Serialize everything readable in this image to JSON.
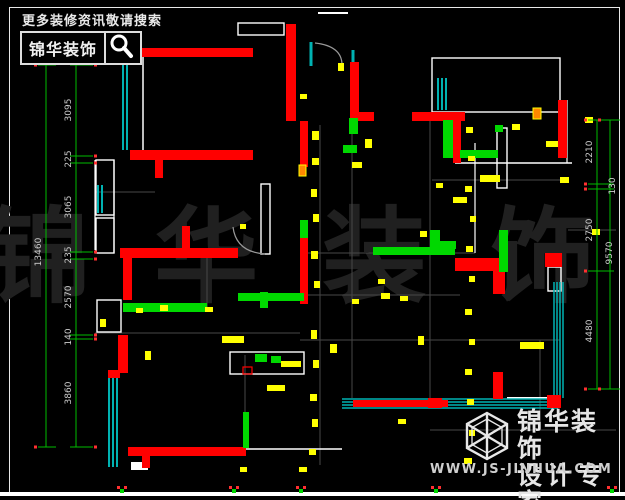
{
  "header": {
    "hint": "更多装修资讯敬请搜索",
    "brand": "锦华装饰",
    "search_icon": "magnifier-icon"
  },
  "watermark": {
    "text": "锦 华 装 饰"
  },
  "logo": {
    "line1": "锦华装饰",
    "line2": "设计专家",
    "url": "WWW.JS-JINHUA.COM",
    "icon": "cube-hexagon-icon"
  },
  "dims": {
    "left": {
      "outer_x": 46,
      "inner_x": 76,
      "y_top": 65,
      "y_bottom": 447,
      "ticks": [
        65,
        156,
        163,
        252,
        259,
        335,
        339,
        447
      ],
      "labels": [
        {
          "t": "3095",
          "y": 110
        },
        {
          "t": "225",
          "y": 159
        },
        {
          "t": "3065",
          "y": 207
        },
        {
          "t": "235",
          "y": 255
        },
        {
          "t": "2570",
          "y": 297
        },
        {
          "t": "140",
          "y": 337
        },
        {
          "t": "3860",
          "y": 393
        }
      ],
      "total": {
        "t": "13460",
        "x": 41,
        "y": 252
      }
    },
    "right": {
      "outer_x": 610,
      "inner_x": 597,
      "y_top": 120,
      "y_bottom": 389,
      "ticks": [
        120,
        184,
        189,
        271,
        389
      ],
      "labels": [
        {
          "t": "2210",
          "x": 592,
          "y": 152
        },
        {
          "t": "130",
          "x": 615,
          "y": 186
        },
        {
          "t": "2750",
          "x": 592,
          "y": 230
        },
        {
          "t": "4480",
          "x": 592,
          "y": 331
        }
      ],
      "total": {
        "t": "9570",
        "x": 612,
        "y": 253
      }
    }
  },
  "plan": {
    "colors": {
      "wall": "#ff0000",
      "window": "#00b2b2",
      "pipe": "#00d800",
      "mark": "#ffff00",
      "dim": "#00bb00",
      "line": "#ffffff",
      "faint": "#474747",
      "dot": "#ff3030",
      "orange": "#ff8800",
      "dim_text": "#cccccc",
      "arc": "#999999"
    },
    "red_walls": [
      [
        135,
        48,
        118,
        9
      ],
      [
        286,
        24,
        10,
        97
      ],
      [
        300,
        121,
        8,
        46
      ],
      [
        300,
        236,
        8,
        68
      ],
      [
        350,
        62,
        9,
        59
      ],
      [
        350,
        112,
        24,
        9
      ],
      [
        412,
        112,
        53,
        9
      ],
      [
        453,
        121,
        8,
        42
      ],
      [
        558,
        100,
        9,
        58
      ],
      [
        130,
        150,
        123,
        10
      ],
      [
        155,
        160,
        8,
        18
      ],
      [
        120,
        248,
        118,
        10
      ],
      [
        182,
        226,
        8,
        22
      ],
      [
        123,
        258,
        9,
        42
      ],
      [
        118,
        335,
        10,
        38
      ],
      [
        108,
        370,
        12,
        8
      ],
      [
        128,
        447,
        118,
        9
      ],
      [
        142,
        456,
        8,
        12
      ],
      [
        455,
        258,
        47,
        13
      ],
      [
        493,
        271,
        12,
        23
      ],
      [
        545,
        253,
        17,
        14
      ],
      [
        493,
        372,
        10,
        27
      ],
      [
        547,
        395,
        14,
        13
      ],
      [
        353,
        400,
        95,
        7
      ],
      [
        428,
        398,
        14,
        10
      ]
    ],
    "red_outlines": [
      [
        243,
        367,
        9,
        7
      ]
    ],
    "orange_marks": [
      [
        299,
        165,
        7,
        11
      ],
      [
        533,
        108,
        8,
        11
      ]
    ],
    "green_bars": [
      [
        123,
        303,
        84,
        9
      ],
      [
        238,
        293,
        66,
        8
      ],
      [
        260,
        292,
        8,
        16
      ],
      [
        373,
        247,
        82,
        8
      ],
      [
        499,
        230,
        9,
        42
      ],
      [
        443,
        120,
        10,
        38
      ],
      [
        460,
        150,
        38,
        8
      ],
      [
        430,
        230,
        10,
        18
      ],
      [
        430,
        241,
        26,
        8
      ],
      [
        243,
        412,
        6,
        36
      ],
      [
        300,
        220,
        8,
        18
      ],
      [
        255,
        354,
        12,
        8
      ],
      [
        271,
        356,
        10,
        7
      ],
      [
        343,
        145,
        14,
        8
      ],
      [
        349,
        118,
        9,
        16
      ],
      [
        495,
        125,
        8,
        7
      ]
    ],
    "yellow_marks": [
      [
        312,
        131,
        7,
        9
      ],
      [
        312,
        158,
        7,
        7
      ],
      [
        311,
        189,
        6,
        8
      ],
      [
        313,
        214,
        6,
        8
      ],
      [
        311,
        251,
        7,
        8
      ],
      [
        314,
        281,
        6,
        7
      ],
      [
        311,
        330,
        6,
        9
      ],
      [
        313,
        360,
        6,
        8
      ],
      [
        310,
        394,
        7,
        7
      ],
      [
        312,
        419,
        6,
        8
      ],
      [
        309,
        449,
        7,
        6
      ],
      [
        466,
        127,
        7,
        6
      ],
      [
        468,
        156,
        7,
        5
      ],
      [
        465,
        186,
        7,
        6
      ],
      [
        470,
        216,
        6,
        6
      ],
      [
        466,
        246,
        7,
        6
      ],
      [
        469,
        276,
        6,
        6
      ],
      [
        465,
        309,
        7,
        6
      ],
      [
        469,
        339,
        6,
        6
      ],
      [
        465,
        369,
        7,
        6
      ],
      [
        467,
        399,
        7,
        6
      ],
      [
        469,
        430,
        6,
        6
      ],
      [
        464,
        458,
        8,
        6
      ],
      [
        381,
        293,
        9,
        6
      ],
      [
        400,
        296,
        8,
        5
      ],
      [
        352,
        299,
        7,
        5
      ],
      [
        160,
        305,
        8,
        6
      ],
      [
        136,
        308,
        7,
        5
      ],
      [
        205,
        307,
        8,
        5
      ],
      [
        222,
        336,
        22,
        7
      ],
      [
        281,
        361,
        20,
        6
      ],
      [
        330,
        344,
        7,
        9
      ],
      [
        418,
        336,
        6,
        9
      ],
      [
        267,
        385,
        18,
        6
      ],
      [
        520,
        342,
        24,
        7
      ],
      [
        480,
        175,
        20,
        7
      ],
      [
        453,
        197,
        14,
        6
      ],
      [
        352,
        162,
        10,
        6
      ],
      [
        365,
        139,
        7,
        9
      ],
      [
        546,
        141,
        12,
        6
      ],
      [
        560,
        177,
        9,
        6
      ],
      [
        585,
        117,
        8,
        6
      ],
      [
        592,
        229,
        8,
        6
      ],
      [
        436,
        183,
        7,
        5
      ],
      [
        512,
        124,
        8,
        6
      ],
      [
        300,
        94,
        7,
        5
      ],
      [
        145,
        351,
        6,
        9
      ],
      [
        100,
        319,
        6,
        8
      ],
      [
        240,
        224,
        6,
        5
      ],
      [
        398,
        419,
        8,
        5
      ],
      [
        299,
        467,
        8,
        5
      ],
      [
        240,
        467,
        7,
        5
      ],
      [
        338,
        63,
        6,
        8
      ],
      [
        420,
        231,
        7,
        6
      ],
      [
        378,
        279,
        7,
        5
      ]
    ],
    "teal_lines": [
      [
        123,
        62,
        123,
        150,
        2
      ],
      [
        127,
        62,
        127,
        150,
        2
      ],
      [
        98,
        185,
        98,
        213,
        2
      ],
      [
        102,
        185,
        102,
        213,
        2
      ],
      [
        109,
        377,
        109,
        467,
        2
      ],
      [
        113,
        377,
        113,
        467,
        2
      ],
      [
        117,
        377,
        117,
        467,
        2
      ],
      [
        342,
        399,
        558,
        399,
        1.5
      ],
      [
        342,
        402,
        558,
        402,
        1.5
      ],
      [
        342,
        405,
        558,
        405,
        1.5
      ],
      [
        342,
        408,
        558,
        408,
        1.5
      ],
      [
        554,
        282,
        554,
        398,
        1.5
      ],
      [
        557,
        282,
        557,
        398,
        1.5
      ],
      [
        560,
        282,
        560,
        398,
        1.5
      ],
      [
        563,
        282,
        563,
        398,
        1.5
      ],
      [
        438,
        78,
        438,
        110,
        2
      ],
      [
        442,
        78,
        442,
        110,
        2
      ],
      [
        446,
        78,
        446,
        110,
        2
      ],
      [
        311,
        42,
        311,
        66,
        3
      ],
      [
        353,
        50,
        353,
        66,
        3
      ]
    ],
    "white_rect_outlines": [
      [
        238,
        23,
        46,
        12
      ],
      [
        432,
        58,
        128,
        54
      ],
      [
        96,
        160,
        18,
        55
      ],
      [
        96,
        218,
        18,
        35
      ],
      [
        261,
        184,
        9,
        70
      ],
      [
        497,
        128,
        10,
        60
      ],
      [
        97,
        300,
        24,
        32
      ],
      [
        230,
        352,
        74,
        22
      ],
      [
        548,
        267,
        13,
        24
      ]
    ],
    "white_rect_fills": [
      [
        131,
        462,
        17,
        8
      ]
    ],
    "white_lines": [
      [
        318,
        13,
        348,
        13,
        2
      ],
      [
        143,
        57,
        143,
        152,
        1.5
      ],
      [
        114,
        160,
        114,
        253,
        1.2
      ],
      [
        475,
        143,
        475,
        253,
        1.2
      ],
      [
        455,
        163,
        572,
        163,
        1.5
      ],
      [
        567,
        100,
        567,
        163,
        1.2
      ],
      [
        246,
        449,
        342,
        449,
        1.5
      ],
      [
        507,
        398,
        547,
        398,
        2
      ],
      [
        95,
        160,
        95,
        250,
        1.2
      ]
    ],
    "gray_lines": [
      [
        320,
        125,
        320,
        465
      ],
      [
        352,
        125,
        352,
        398
      ],
      [
        430,
        120,
        430,
        400
      ],
      [
        540,
        340,
        540,
        430
      ],
      [
        207,
        250,
        207,
        310
      ],
      [
        245,
        355,
        245,
        412
      ],
      [
        305,
        295,
        460,
        295
      ],
      [
        300,
        340,
        560,
        340
      ],
      [
        430,
        430,
        616,
        430
      ],
      [
        300,
        253,
        475,
        253
      ],
      [
        96,
        192,
        155,
        192
      ],
      [
        432,
        180,
        560,
        180
      ],
      [
        568,
        230,
        616,
        230
      ],
      [
        95,
        333,
        300,
        333
      ]
    ],
    "door_arcs": [
      "M315,43 Q342,46 342,65",
      "M265,254 Q236,252 233,227"
    ],
    "bottom_ticks": [
      122,
      234,
      301,
      436,
      612
    ]
  }
}
